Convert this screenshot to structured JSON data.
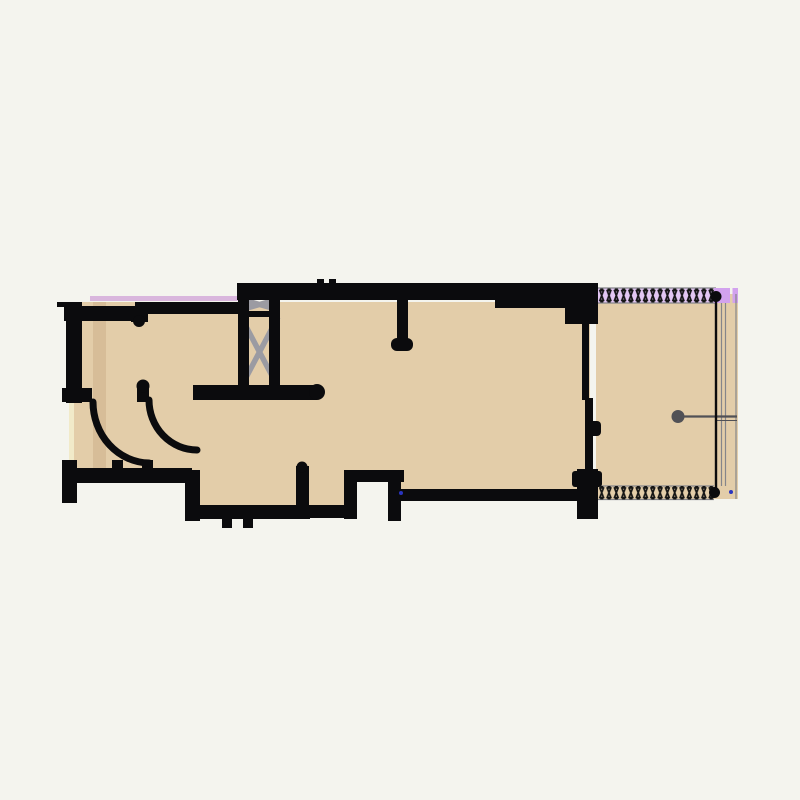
{
  "document": {
    "kind": "architectural-floor-plan",
    "visible_text": ""
  },
  "colors": {
    "background": "#f4f4ee",
    "wall": "#0b0b0d",
    "floor": "#e3cda9",
    "floor_shade": "#d7bd98",
    "lavender": "#e2c6f2",
    "purple": "#d2a2ee",
    "purple_line": "#d9b6dd",
    "hatch": "#151515",
    "brace": "#9b9ba2",
    "gline": "#85858a",
    "section": "#515156",
    "window": "#f1eac9",
    "marker_blue": "#2a35c0"
  },
  "symbols": {
    "elevator_shaft": "x-braced-shaft-icon",
    "double_door": "quarter-circle-door-swing-icon",
    "insulation_band": "zipper-hatch-icon",
    "railing": "line-with-end-dots-icon",
    "section_marker": "dot-with-leader-line-icon"
  }
}
